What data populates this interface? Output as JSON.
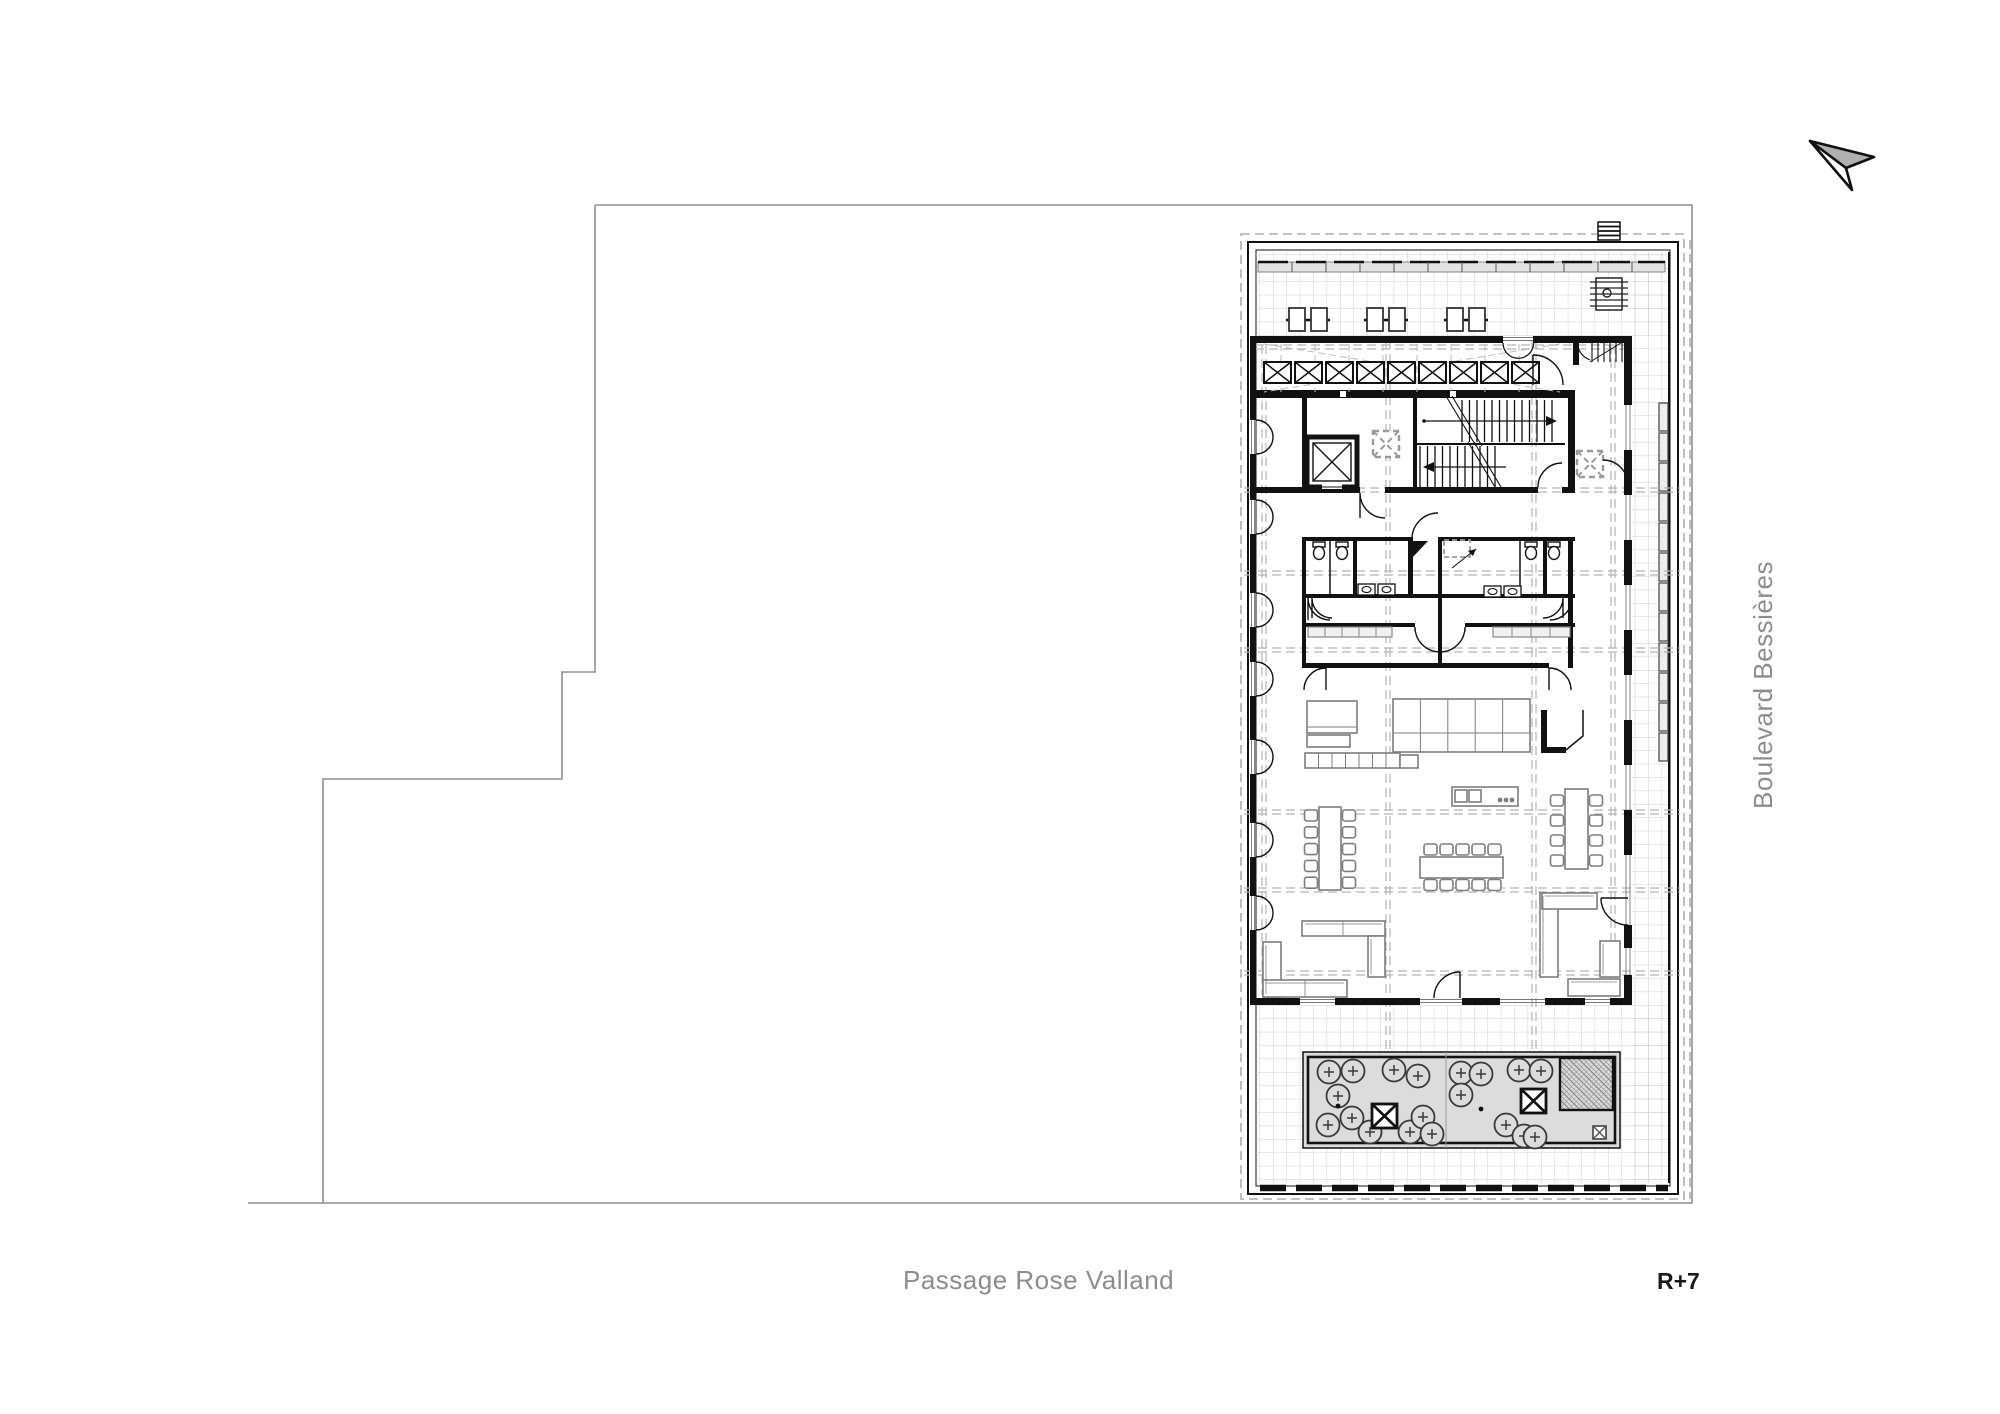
{
  "document": {
    "type": "architectural-floor-plan",
    "drawing": "roof-level plan with surrounding site boundary"
  },
  "labels": {
    "street_bottom": "Passage Rose Valland",
    "street_right": "Boulevard Bessières",
    "level": "R+7"
  },
  "north_arrow": {
    "icon": "north-arrow-icon",
    "direction": "up-left"
  },
  "colors": {
    "background": "#ffffff",
    "site_line": "#8f8f8f",
    "label_gray": "#8c8c8c",
    "label_black": "#1a1a1a",
    "wall_black": "#111111",
    "tile_grid": "#cfcfcf",
    "dashed_grid": "#b5b5b5",
    "planter_fill": "#dcdcdc",
    "furniture_gray": "#7d7d7d"
  }
}
